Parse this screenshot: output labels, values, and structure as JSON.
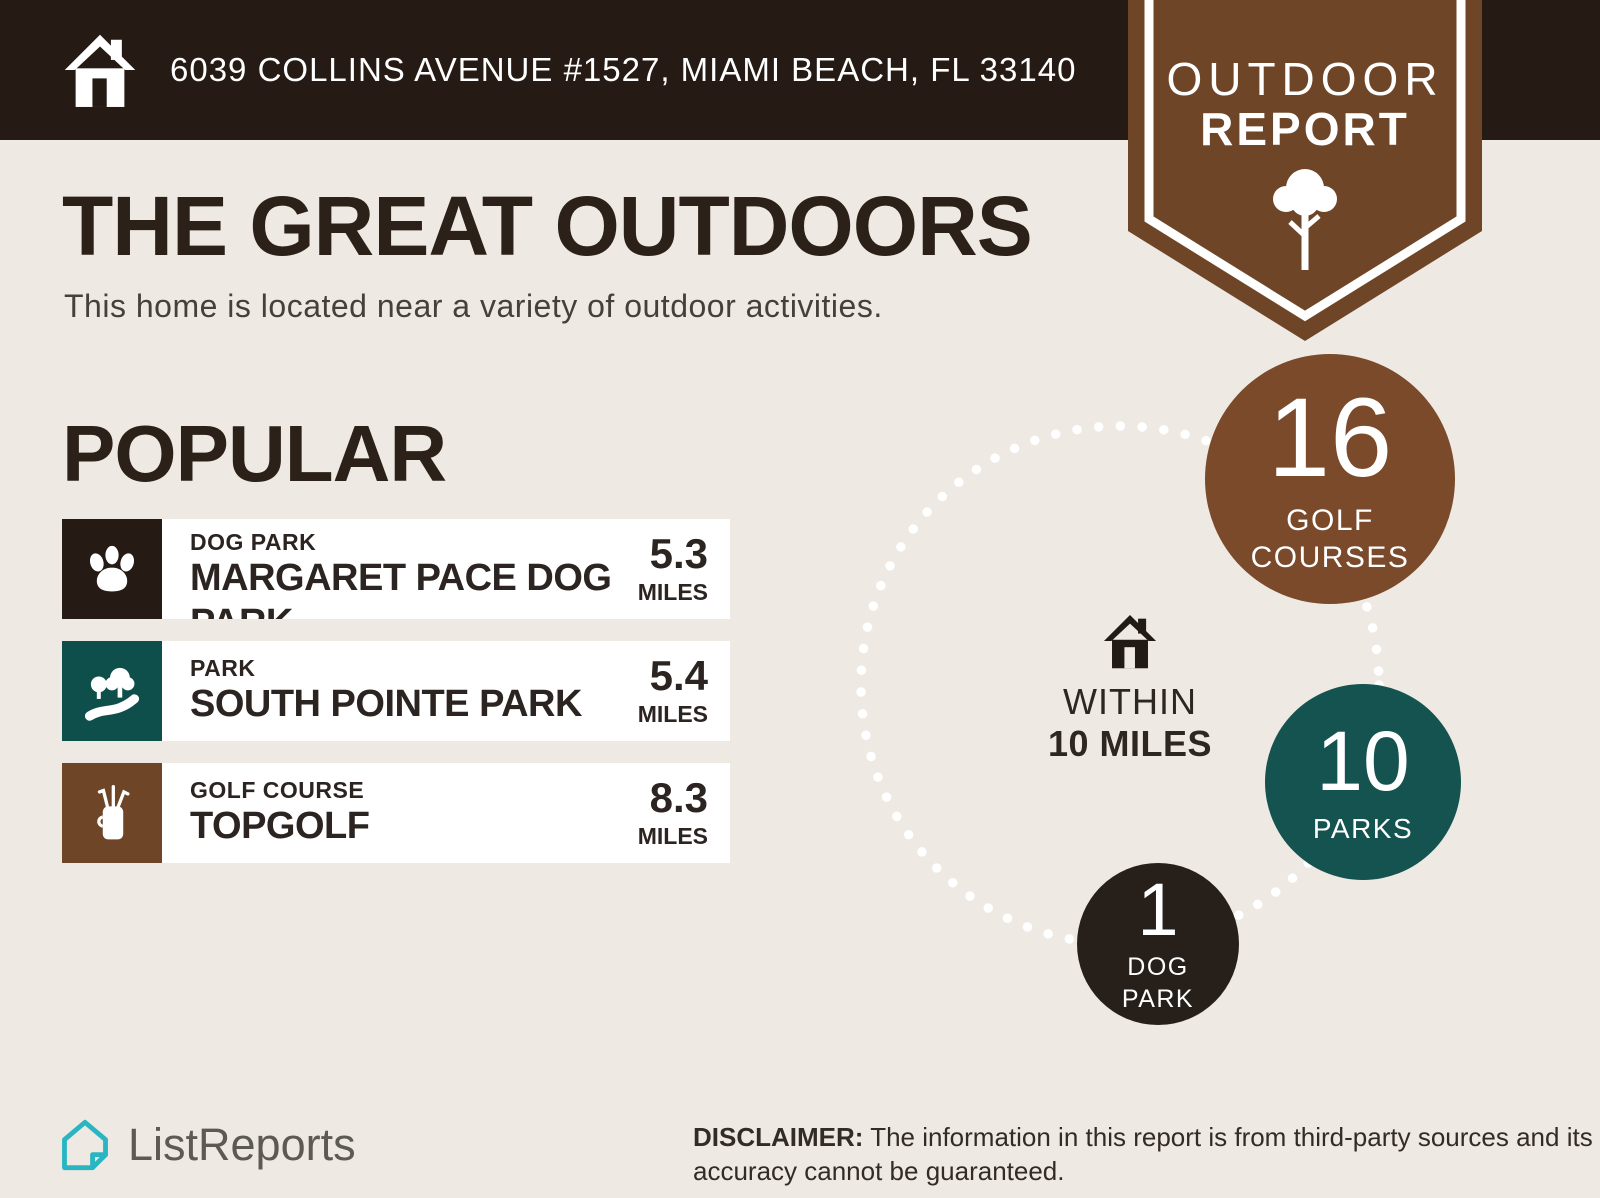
{
  "address_bar": {
    "address": "6039 COLLINS AVENUE #1527, MIAMI BEACH, FL 33140"
  },
  "ribbon": {
    "line1": "OUTDOOR",
    "line2": "REPORT"
  },
  "intro": {
    "title": "THE GREAT OUTDOORS",
    "subtitle": "This home is located near a variety of outdoor activities."
  },
  "popular": {
    "heading": "POPULAR",
    "items": [
      {
        "category": "DOG PARK",
        "name": "MARGARET PACE DOG PARK",
        "distance": "5.3",
        "unit": "MILES",
        "icon": "paw-icon",
        "color": "#251b14"
      },
      {
        "category": "PARK",
        "name": "SOUTH POINTE PARK",
        "distance": "5.4",
        "unit": "MILES",
        "icon": "park-icon",
        "color": "#0f4f4b"
      },
      {
        "category": "GOLF COURSE",
        "name": "TOPGOLF",
        "distance": "8.3",
        "unit": "MILES",
        "icon": "golf-bag-icon",
        "color": "#6f4527"
      }
    ]
  },
  "radius_viz": {
    "center_label_line1": "WITHIN",
    "center_label_line2": "10 MILES",
    "stats": [
      {
        "value": "16",
        "label": "GOLF COURSES",
        "color": "#7a4a2b"
      },
      {
        "value": "10",
        "label": "PARKS",
        "color": "#14534f"
      },
      {
        "value": "1",
        "label": "DOG PARK",
        "color": "#27201a"
      }
    ]
  },
  "footer": {
    "brand": "ListReports",
    "disclaimer_label": "DISCLAIMER:",
    "disclaimer_text": " The information in this report is from third-party sources and its accuracy cannot be guaranteed."
  },
  "colors": {
    "topbar_bg": "#251b14",
    "page_bg": "#efe9e4",
    "card_bg": "#ffffff",
    "ribbon_brown": "#6f4527",
    "golf_brown": "#7a4a2b",
    "teal": "#0f4f4b",
    "teal_circle": "#14534f",
    "near_black": "#27201a",
    "text_dark": "#2b2118",
    "logo_teal": "#2ab5c2",
    "logo_gray": "#5d5955",
    "dots": "#ffffff"
  }
}
